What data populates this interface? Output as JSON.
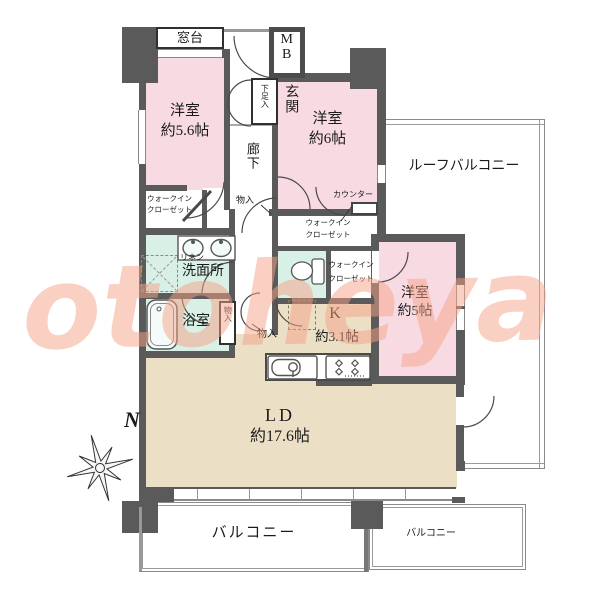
{
  "watermark_text": "otoheya",
  "compass": {
    "north": "N"
  },
  "rooms": {
    "bedroom1": {
      "name": "洋室",
      "size": "約5.6帖"
    },
    "bedroom2": {
      "name": "洋室",
      "size": "約6帖"
    },
    "bedroom3": {
      "name": "洋室",
      "size": "約5帖"
    },
    "living_dining": {
      "name": "LD",
      "size": "約17.6帖"
    },
    "kitchen": {
      "name": "K",
      "size": "約3.1帖"
    },
    "washroom": "洗面所",
    "bathroom": "浴室",
    "entrance": "玄関",
    "corridor": "廊下",
    "roof_balcony": "ルーフバルコニー",
    "balcony_main": "バルコニー",
    "balcony_sub": "バルコニー"
  },
  "labels": {
    "window_sill": "窓台",
    "meter_box": "MB",
    "shoe_cabinet": "下足入",
    "walk_in_closet_line1": "ウォークイン",
    "walk_in_closet_line2": "クローゼット",
    "storage": "物入",
    "counter": "カウンター",
    "linen": "リネン"
  },
  "colors": {
    "room_pink": "#f8dbe2",
    "room_beige": "#ebdfc6",
    "room_mint": "#d9f0e6",
    "wall_dark": "#5a5a5a",
    "watermark": "#f5a287"
  }
}
